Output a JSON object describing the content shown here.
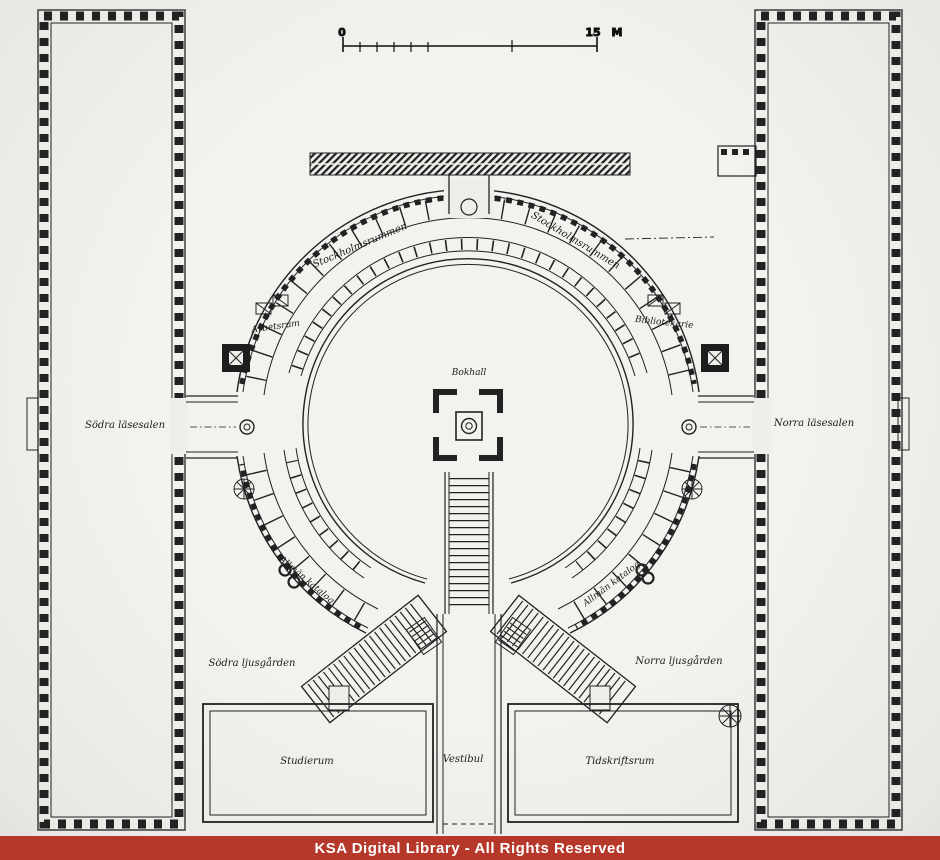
{
  "plan": {
    "rooms": {
      "bokhall": "Bokhall",
      "stockholmsrummen_left": "Stockholmsrummen",
      "stockholmsrummen_right": "Stockholmsrummen",
      "arbetsrum": "Arbetsrum",
      "bibliotekarie": "Bibliotekarie",
      "sodra_lasesalen": "Södra läsesalen",
      "norra_lasesalen": "Norra läsesalen",
      "allman_katalog_left": "Allmän katalog",
      "allman_katalog_right": "Allmän katalog",
      "sodra_ljusgarden": "Södra ljusgården",
      "norra_ljusgarden": "Norra ljusgården",
      "studierum": "Studierum",
      "vestibul": "Vestibul",
      "tidskriftsrum": "Tidskriftsrum"
    }
  },
  "scale_bar": {
    "zero_label": "0",
    "end_label": "15",
    "unit_label": "M"
  },
  "watermark": {
    "text": "KSA Digital Library - All Rights Reserved",
    "bg_color": "#b5382b",
    "text_color": "#ffffff"
  },
  "colors": {
    "paper": "#efeeea",
    "ink": "#222222"
  }
}
